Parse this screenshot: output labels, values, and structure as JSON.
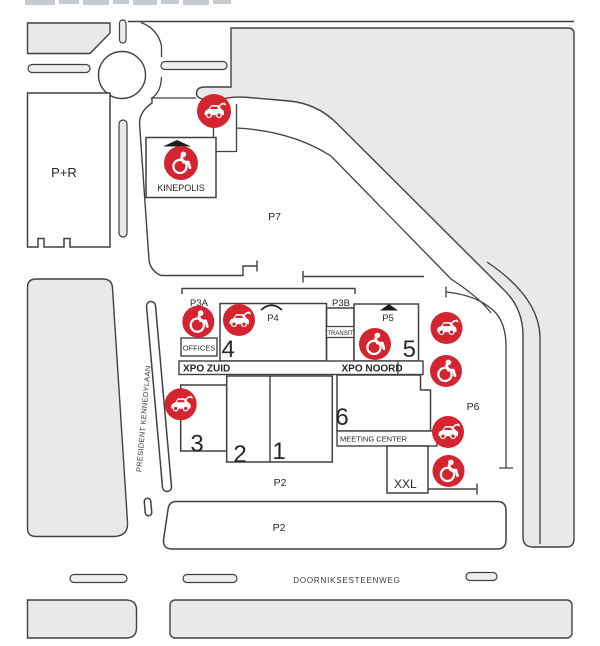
{
  "map_title": "venue and parking site map",
  "colors": {
    "accent_red": "#d42430",
    "block_gray": "#e9e9e9",
    "outline": "#414141",
    "text": "#272727"
  },
  "labels": {
    "par": "P+R",
    "kinepolis": "KINEPOLIS",
    "p7": "P7",
    "p3a": "P3A",
    "p3b": "P3B",
    "p4": "P4",
    "p5": "P5",
    "p6": "P6",
    "offices": "OFFICES",
    "transit": "TRANSIT",
    "xpo_zuid": "XPO ZUID",
    "xpo_noord": "XPO NOORD",
    "hall1": "1",
    "hall2": "2",
    "hall3": "3",
    "hall4": "4",
    "hall5": "5",
    "hall6": "6",
    "meeting_center": "MEETING CENTER",
    "xxl": "XXL",
    "p2_inner": "P2",
    "p2_strip": "P2",
    "doorniksesteenweg": "DOORNIKSESTEENWEG",
    "president_kennedylaan": "PRESIDENT KENNEDYLAAN"
  },
  "icons": [
    {
      "name": "ev-charging-icon",
      "area": "kinepolis-dropoff"
    },
    {
      "name": "wheelchair-icon",
      "area": "kinepolis"
    },
    {
      "name": "wheelchair-icon",
      "area": "p3a"
    },
    {
      "name": "ev-charging-icon",
      "area": "hall-4"
    },
    {
      "name": "wheelchair-icon",
      "area": "hall-5"
    },
    {
      "name": "ev-charging-icon",
      "area": "p6-north"
    },
    {
      "name": "wheelchair-icon",
      "area": "p6-upper"
    },
    {
      "name": "ev-charging-icon",
      "area": "p6-lower"
    },
    {
      "name": "wheelchair-icon",
      "area": "p6-south"
    },
    {
      "name": "ev-charging-icon",
      "area": "hall-3"
    }
  ]
}
